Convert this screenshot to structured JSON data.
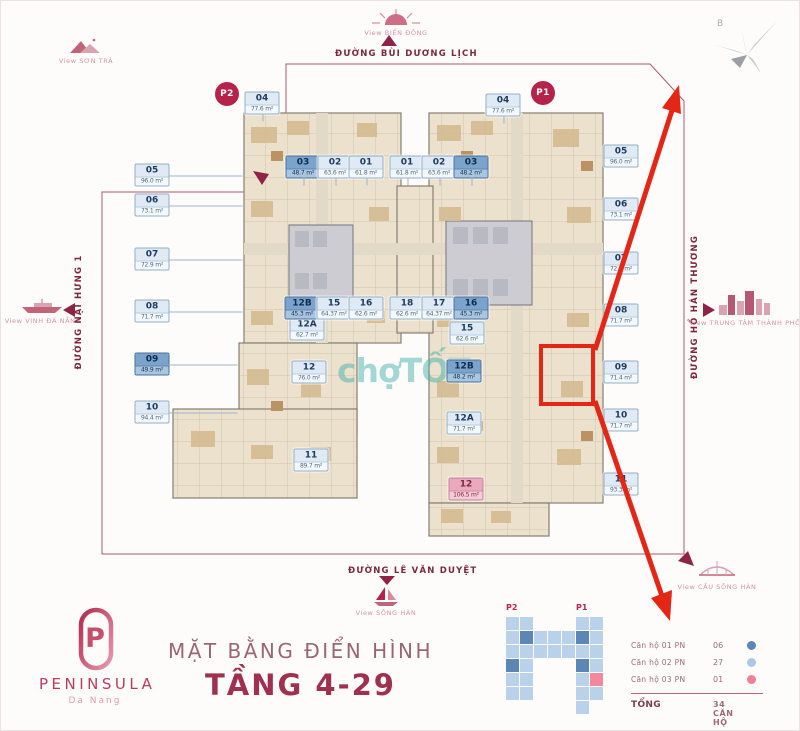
{
  "brand": {
    "monogram": "P",
    "name": "PENINSULA",
    "sub": "Da Nang"
  },
  "title": {
    "line1": "MẶT BẰNG ĐIỂN HÌNH",
    "line2": "TẦNG 4-29"
  },
  "compass": {
    "north_label": "B"
  },
  "watermark": "chợTỐT",
  "streets": {
    "top": "ĐƯỜNG BÙI DƯƠNG LỊCH",
    "bottom": "ĐƯỜNG LÊ VĂN DUYỆT",
    "left": "ĐƯỜNG NẠI HƯNG 1",
    "right": "ĐƯỜNG HỒ HÁN THƯƠNG"
  },
  "views": {
    "son_tra": "View SƠN TRÀ",
    "bien_dong": "View BIỂN ĐÔNG",
    "vinh_da_nang": "View VỊNH ĐÀ NẴNG",
    "trung_tam": "View TRUNG TÂM THÀNH PHỐ",
    "song_han": "View SÔNG HÀN",
    "cau_song_han": "View CẦU SÔNG HÀN"
  },
  "towers": {
    "p2": "P2",
    "p1": "P1"
  },
  "units": [
    {
      "tower": "P2",
      "no": "04",
      "area": "77.6 m²",
      "t": "light",
      "x": 261,
      "y": 102,
      "conn": "down"
    },
    {
      "tower": "P2",
      "no": "05",
      "area": "96.0 m²",
      "t": "light",
      "x": 151,
      "y": 174,
      "conn": "right",
      "len": 74
    },
    {
      "tower": "P2",
      "no": "06",
      "area": "73.1 m²",
      "t": "light",
      "x": 151,
      "y": 204,
      "conn": "right",
      "len": 74
    },
    {
      "tower": "P2",
      "no": "07",
      "area": "72.9 m²",
      "t": "light",
      "x": 151,
      "y": 258,
      "conn": "right",
      "len": 74
    },
    {
      "tower": "P2",
      "no": "08",
      "area": "71.7 m²",
      "t": "light",
      "x": 151,
      "y": 310,
      "conn": "right",
      "len": 74
    },
    {
      "tower": "P2",
      "no": "09",
      "area": "49.9 m²",
      "t": "dark",
      "x": 151,
      "y": 363,
      "conn": "right",
      "len": 69
    },
    {
      "tower": "P2",
      "no": "10",
      "area": "94.4 m²",
      "t": "light",
      "x": 151,
      "y": 411,
      "conn": "right",
      "len": 69
    },
    {
      "tower": "P2",
      "no": "11",
      "area": "89.7 m²",
      "t": "light",
      "x": 310,
      "y": 459,
      "conn": "none"
    },
    {
      "tower": "P2",
      "no": "12",
      "area": "76.0 m²",
      "t": "light",
      "x": 308,
      "y": 371,
      "conn": "none"
    },
    {
      "tower": "P2",
      "no": "12A",
      "area": "62.7 m²",
      "t": "light",
      "x": 306,
      "y": 328,
      "conn": "none"
    },
    {
      "tower": "P2",
      "no": "12B",
      "area": "45.3 m²",
      "t": "dark",
      "x": 301,
      "y": 307,
      "conn": "none"
    },
    {
      "tower": "P2",
      "no": "15",
      "area": "64.37 m²",
      "t": "light",
      "x": 333,
      "y": 307,
      "conn": "none"
    },
    {
      "tower": "P2",
      "no": "16",
      "area": "62.6 m²",
      "t": "light",
      "x": 365,
      "y": 307,
      "conn": "none"
    },
    {
      "tower": "P2",
      "no": "03",
      "area": "48.7 m²",
      "t": "dark",
      "x": 302,
      "y": 166,
      "conn": "down"
    },
    {
      "tower": "P2",
      "no": "02",
      "area": "63.6 m²",
      "t": "light",
      "x": 334,
      "y": 166,
      "conn": "down"
    },
    {
      "tower": "P2",
      "no": "01",
      "area": "61.8 m²",
      "t": "light",
      "x": 365,
      "y": 166,
      "conn": "down"
    },
    {
      "tower": "P1",
      "no": "01",
      "area": "61.8 m²",
      "t": "light",
      "x": 406,
      "y": 166,
      "conn": "down"
    },
    {
      "tower": "P1",
      "no": "02",
      "area": "63.6 m²",
      "t": "light",
      "x": 438,
      "y": 166,
      "conn": "down"
    },
    {
      "tower": "P1",
      "no": "03",
      "area": "48.2 m²",
      "t": "dark",
      "x": 470,
      "y": 166,
      "conn": "down"
    },
    {
      "tower": "P1",
      "no": "18",
      "area": "62.6 m²",
      "t": "light",
      "x": 406,
      "y": 307,
      "conn": "none"
    },
    {
      "tower": "P1",
      "no": "17",
      "area": "64.37 m²",
      "t": "light",
      "x": 438,
      "y": 307,
      "conn": "none"
    },
    {
      "tower": "P1",
      "no": "16",
      "area": "45.3 m²",
      "t": "dark",
      "x": 470,
      "y": 307,
      "conn": "none"
    },
    {
      "tower": "P1",
      "no": "15",
      "area": "62.6 m²",
      "t": "light",
      "x": 466,
      "y": 332,
      "conn": "none"
    },
    {
      "tower": "P1",
      "no": "12B",
      "area": "48.2 m²",
      "t": "dark",
      "x": 463,
      "y": 370,
      "conn": "none"
    },
    {
      "tower": "P1",
      "no": "12A",
      "area": "71.7 m²",
      "t": "light",
      "x": 463,
      "y": 422,
      "conn": "none"
    },
    {
      "tower": "P1",
      "no": "12",
      "area": "106.5 m²",
      "t": "pink",
      "x": 465,
      "y": 488,
      "conn": "none"
    },
    {
      "tower": "P1",
      "no": "04",
      "area": "77.6 m²",
      "t": "light",
      "x": 502,
      "y": 104,
      "conn": "down"
    },
    {
      "tower": "P1",
      "no": "05",
      "area": "96.0 m²",
      "t": "light",
      "x": 620,
      "y": 155,
      "conn": "none"
    },
    {
      "tower": "P1",
      "no": "06",
      "area": "73.1 m²",
      "t": "light",
      "x": 620,
      "y": 208,
      "conn": "none"
    },
    {
      "tower": "P1",
      "no": "07",
      "area": "72.9 m²",
      "t": "light",
      "x": 620,
      "y": 262,
      "conn": "none"
    },
    {
      "tower": "P1",
      "no": "08",
      "area": "71.7 m²",
      "t": "light",
      "x": 620,
      "y": 314,
      "conn": "none"
    },
    {
      "tower": "P1",
      "no": "09",
      "area": "71.4 m²",
      "t": "light",
      "x": 620,
      "y": 371,
      "conn": "none"
    },
    {
      "tower": "P1",
      "no": "10",
      "area": "71.7 m²",
      "t": "light",
      "x": 620,
      "y": 419,
      "conn": "none"
    },
    {
      "tower": "P1",
      "no": "11",
      "area": "93.3 m²",
      "t": "light",
      "x": 620,
      "y": 483,
      "conn": "none"
    }
  ],
  "highlight": {
    "unit": "09",
    "tower": "P1"
  },
  "legend": {
    "rows": [
      {
        "label": "Căn hộ 01 PN",
        "value": "06",
        "color": "#5b87b7"
      },
      {
        "label": "Căn hộ 02 PN",
        "value": "27",
        "color": "#abc9e5"
      },
      {
        "label": "Căn hộ 03 PN",
        "value": "01",
        "color": "#ee7f96"
      }
    ],
    "total_label": "TỔNG",
    "total_value": "34 CĂN HỘ",
    "miniplan": {
      "cells": [
        [
          8,
          16,
          "L"
        ],
        [
          8,
          30,
          "L"
        ],
        [
          8,
          44,
          "L"
        ],
        [
          8,
          58,
          "D"
        ],
        [
          8,
          72,
          "L"
        ],
        [
          8,
          86,
          "L"
        ],
        [
          22,
          16,
          "L"
        ],
        [
          22,
          30,
          "D"
        ],
        [
          22,
          44,
          "L"
        ],
        [
          22,
          58,
          "L"
        ],
        [
          22,
          72,
          "L"
        ],
        [
          22,
          86,
          "L"
        ],
        [
          36,
          30,
          "L"
        ],
        [
          50,
          30,
          "L"
        ],
        [
          64,
          30,
          "L"
        ],
        [
          36,
          44,
          "L"
        ],
        [
          50,
          44,
          "L"
        ],
        [
          64,
          44,
          "L"
        ],
        [
          78,
          16,
          "L"
        ],
        [
          78,
          30,
          "D"
        ],
        [
          78,
          44,
          "L"
        ],
        [
          78,
          58,
          "D"
        ],
        [
          78,
          72,
          "L"
        ],
        [
          78,
          86,
          "L"
        ],
        [
          78,
          100,
          "L"
        ],
        [
          92,
          16,
          "L"
        ],
        [
          92,
          30,
          "L"
        ],
        [
          92,
          44,
          "L"
        ],
        [
          92,
          58,
          "L"
        ],
        [
          92,
          72,
          "P"
        ],
        [
          92,
          86,
          "L"
        ]
      ]
    }
  },
  "colors": {
    "brand_accent": "#b5224a",
    "annotation_red": "#e42617",
    "unit_dark": "#7ba3cb",
    "unit_light": "#dfeaf4",
    "unit_pink": "#eaa9bd",
    "watermark_teal": "#48b2ac"
  }
}
